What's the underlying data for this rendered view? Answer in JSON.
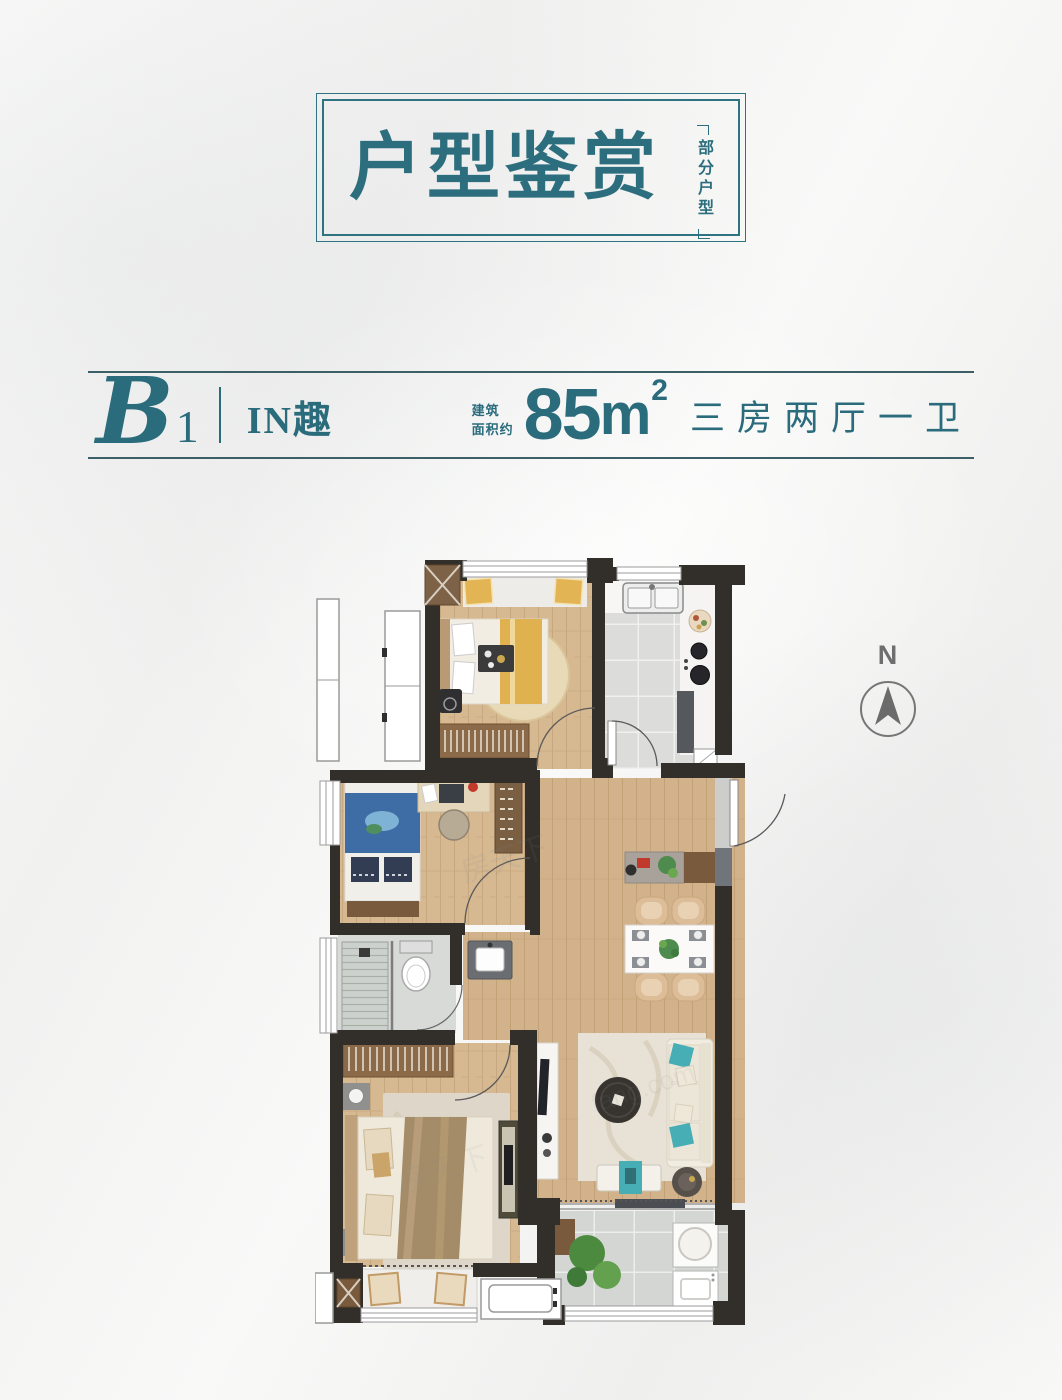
{
  "title_box": {
    "title": "户型鉴赏",
    "side_note": "部分户型"
  },
  "unit_info": {
    "code_letter": "B",
    "code_number": "1",
    "name": "IN趣",
    "area_label_line1": "建筑",
    "area_label_line2": "面积约",
    "area_value": "85",
    "area_unit": "m",
    "area_exponent": "2",
    "layout": "三房两厅一卫"
  },
  "compass": {
    "north_label": "N"
  },
  "floor_plan": {
    "watermark_1": "房天下",
    "watermark_2": "fang.com",
    "watermark_3": "房天下"
  },
  "colors": {
    "accent_teal": "#2c6e7d",
    "rule_line": "#3c5f68",
    "wall_dark": "#322e2a",
    "wall_gray": "#70757b",
    "wood_floor": "#d6b891",
    "tile": "#dcdcda",
    "marble_rug": "#e8e2d6",
    "sofa_teal": "#47aeb6",
    "pillow_gold": "#e3b453",
    "kids_blue": "#3e6da6",
    "compass_gray": "#6e6e6e"
  }
}
